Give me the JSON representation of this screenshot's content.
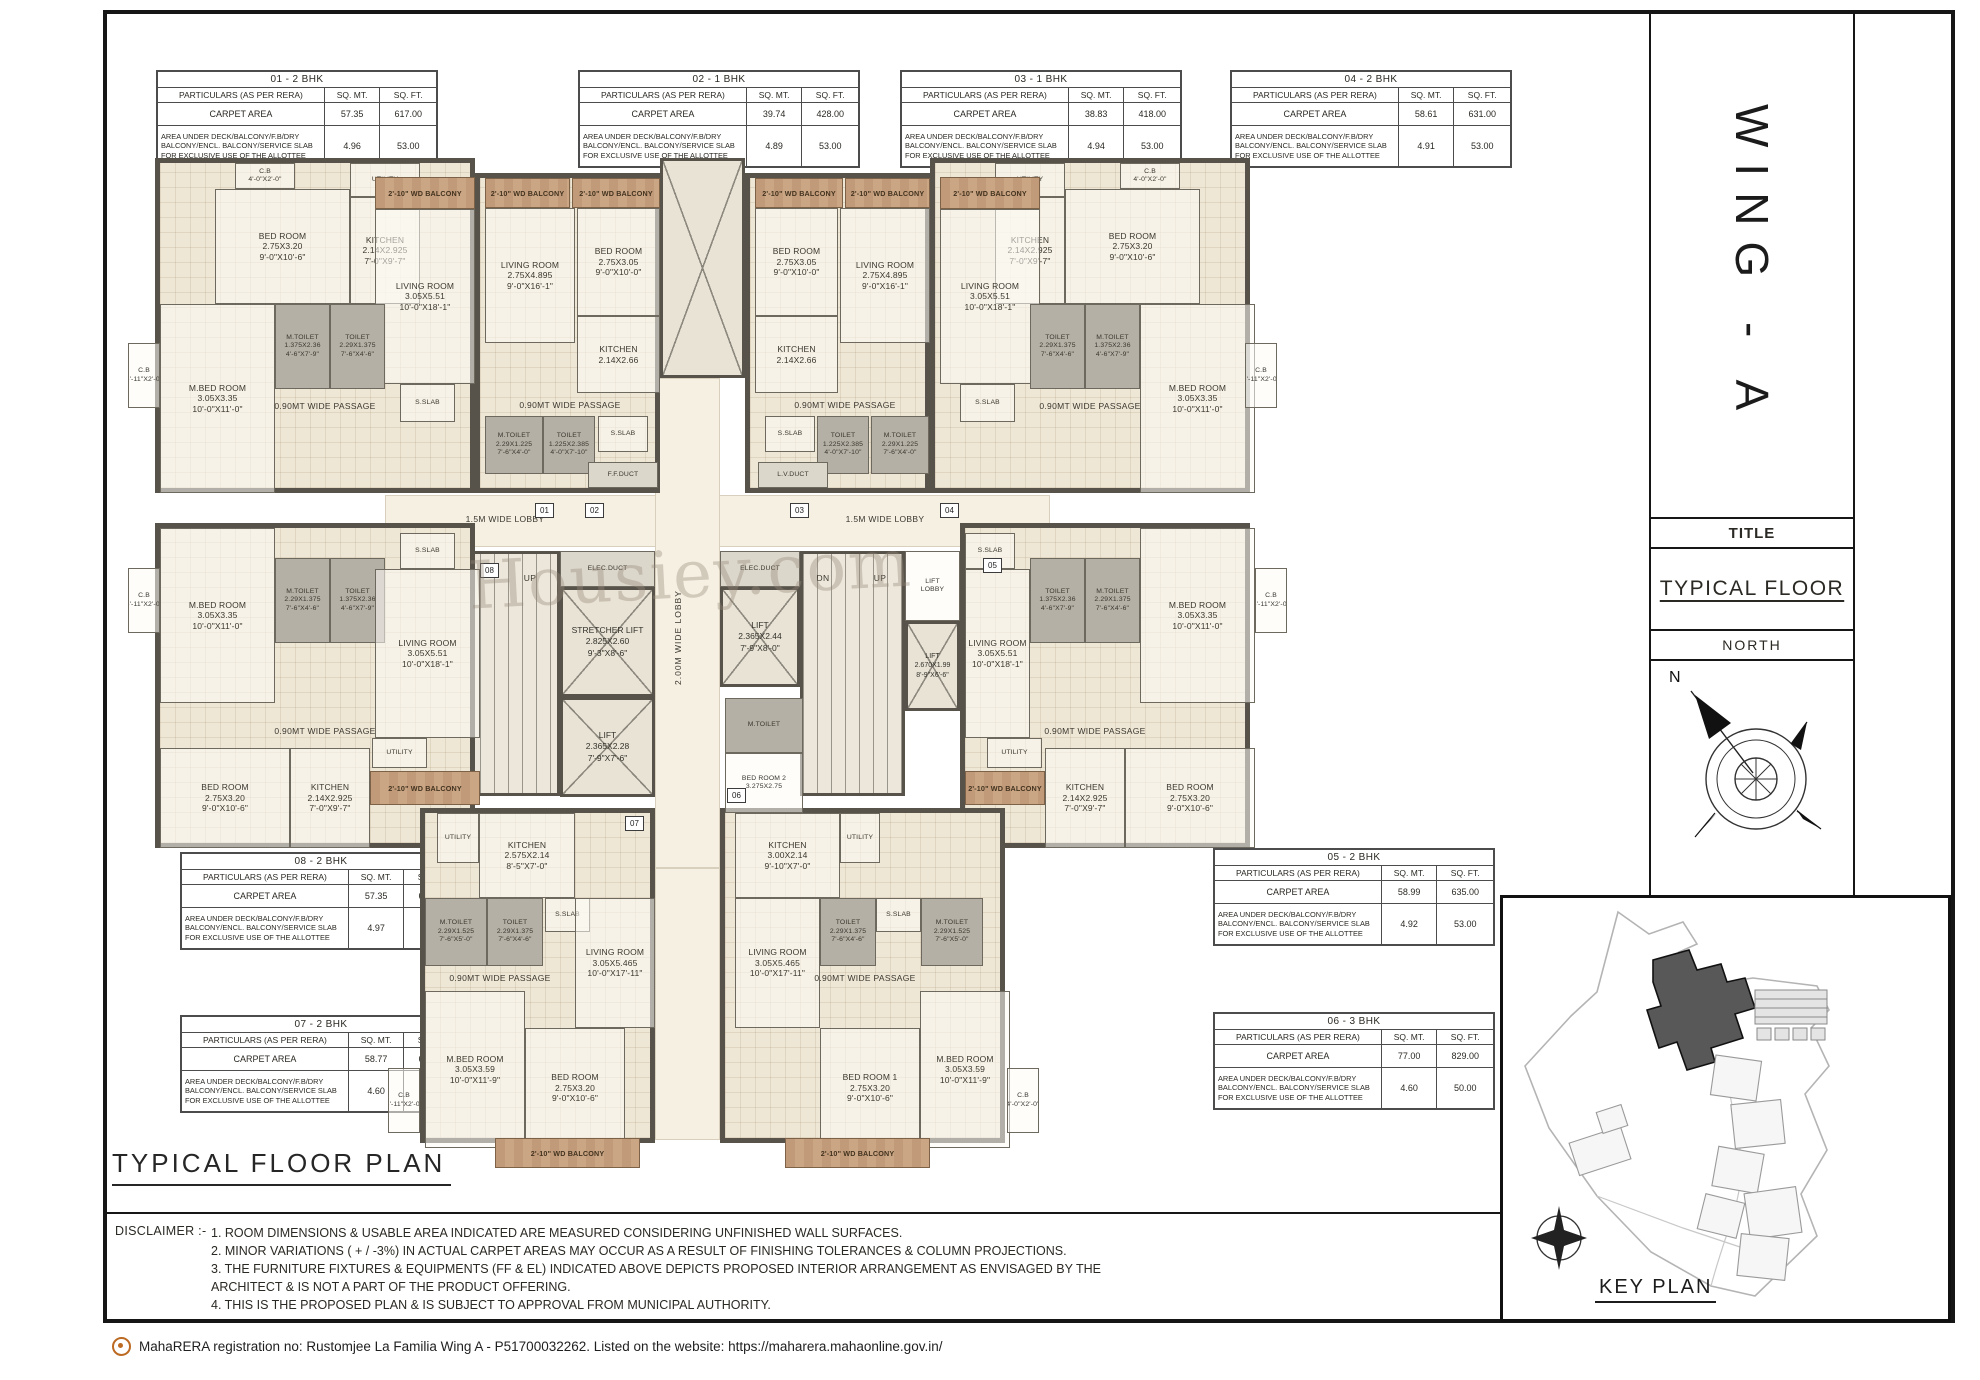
{
  "sheet": {
    "heading": "TYPICAL  FLOOR  PLAN",
    "watermark": "Housiey.com",
    "footer": "MahaRERA registration no: Rustomjee La Familia Wing A - P51700032262. Listed on the website: https://maharera.mahaonline.gov.in/"
  },
  "sidebar": {
    "wing": "WING - A",
    "title_label": "TITLE",
    "title_value": "TYPICAL FLOOR",
    "north_label": "NORTH",
    "north_n": "N",
    "keyplan_label": "KEY PLAN"
  },
  "disclaimer": {
    "label": "DISCLAIMER :-",
    "items": [
      "1. ROOM DIMENSIONS & USABLE  AREA INDICATED  ARE MEASURED CONSIDERING UNFINISHED WALL SURFACES.",
      "2. MINOR VARIATIONS ( + / -3%) IN ACTUAL CARPET AREAS MAY OCCUR AS A RESULT OF  FINISHING TOLERANCES & COLUMN PROJECTIONS.",
      "3. THE FURNITURE FIXTURES & EQUIPMENTS (FF & EL)  INDICATED ABOVE  DEPICTS PROPOSED INTERIOR ARRANGEMENT AS ENVISAGED BY  THE\n      ARCHITECT & IS NOT A PART OF THE PRODUCT OFFERING.",
      "4. THIS IS THE PROPOSED PLAN & IS SUBJECT TO APPROVAL FROM MUNICIPAL AUTHORITY."
    ]
  },
  "table_common": {
    "col_particulars": "PARTICULARS (AS PER RERA)",
    "col_sqmt": "SQ. MT.",
    "col_sqft": "SQ. FT.",
    "carpet_label": "CARPET AREA",
    "deck_label": "AREA UNDER DECK/BALCONY/F.B/DRY BALCONY/ENCL. BALCONY/SERVICE SLAB FOR EXCLUSIVE USE OF THE ALLOTTEE"
  },
  "tables": [
    {
      "id": "01",
      "title": "01 - 2 BHK",
      "carpet_sqmt": "57.35",
      "carpet_sqft": "617.00",
      "deck_sqmt": "4.96",
      "deck_sqft": "53.00"
    },
    {
      "id": "02",
      "title": "02 - 1 BHK",
      "carpet_sqmt": "39.74",
      "carpet_sqft": "428.00",
      "deck_sqmt": "4.89",
      "deck_sqft": "53.00"
    },
    {
      "id": "03",
      "title": "03 - 1 BHK",
      "carpet_sqmt": "38.83",
      "carpet_sqft": "418.00",
      "deck_sqmt": "4.94",
      "deck_sqft": "53.00"
    },
    {
      "id": "04",
      "title": "04 - 2 BHK",
      "carpet_sqmt": "58.61",
      "carpet_sqft": "631.00",
      "deck_sqmt": "4.91",
      "deck_sqft": "53.00"
    },
    {
      "id": "05",
      "title": "05 - 2 BHK",
      "carpet_sqmt": "58.99",
      "carpet_sqft": "635.00",
      "deck_sqmt": "4.92",
      "deck_sqft": "53.00"
    },
    {
      "id": "06",
      "title": "06 - 3 BHK",
      "carpet_sqmt": "77.00",
      "carpet_sqft": "829.00",
      "deck_sqmt": "4.60",
      "deck_sqft": "50.00"
    },
    {
      "id": "07",
      "title": "07 - 2 BHK",
      "carpet_sqmt": "58.77",
      "carpet_sqft": "633.00",
      "deck_sqmt": "4.60",
      "deck_sqft": "50.00"
    },
    {
      "id": "08",
      "title": "08 - 2 BHK",
      "carpet_sqmt": "57.35",
      "carpet_sqft": "617.00",
      "deck_sqmt": "4.97",
      "deck_sqft": "53.00"
    }
  ],
  "plan": {
    "tags": [
      "01",
      "02",
      "03",
      "04",
      "05",
      "06",
      "07",
      "08"
    ],
    "core": {
      "lobby": "1.5M WIDE LOBBY",
      "vlobby": "2.00M WIDE LOBBY",
      "elec": "ELEC.DUCT",
      "stretcher": "STRETCHER LIFT\n2.825X2.60\n9'-3\"X8'-6\"",
      "lift1": "LIFT\n2.365X2.28\n7'-9\"X7'-6\"",
      "lift2": "LIFT\n2.365X2.44\n7'-9\"X8'-0\"",
      "lift4": "LIFT\n2.670X1.99\n8'-9\"X6'-6\"",
      "liftlobby": "LIFT\nLOBBY",
      "dn": "DN",
      "up": "UP",
      "wpass": "1.20 MT WD PASSAGE"
    },
    "units": {
      "u01": {
        "cb1": "C.B\n4'-0\"X2'-0\"",
        "bed": "BED ROOM\n2.75X3.20\n9'-0\"X10'-6\"",
        "utility": "UTILITY",
        "kitchen": "KITCHEN\n2.14X2.925\n7'-0\"X9'-7\"",
        "balcony": "2'-10\" WD BALCONY",
        "living": "LIVING ROOM\n3.05X5.51\n10'-0\"X18'-1\"",
        "mbed": "M.BED ROOM\n3.05X3.35\n10'-0\"X11'-0\"",
        "mtoilet": "M.TOILET\n1.375X2.36\n4'-6\"X7'-9\"",
        "toilet": "TOILET\n2.29X1.375\n7'-6\"X4'-6\"",
        "sslab": "S.SLAB",
        "passage": "0.90MT WIDE PASSAGE",
        "cb2": "C.B\n5'-11\"X2'-0\""
      },
      "u02": {
        "balcony": "2'-10\" WD BALCONY",
        "living": "LIVING ROOM\n2.75X4.895\n9'-0\"X16'-1\"",
        "bed": "BED ROOM\n2.75X3.05\n9'-0\"X10'-0\"",
        "kitchen": "KITCHEN\n2.14X2.66",
        "mtoilet": "M.TOILET\n2.29X1.225\n7'-6\"X4'-0\"",
        "toilet": "TOILET\n1.225X2.385\n4'-0\"X7'-10\"",
        "sslab": "S.SLAB",
        "passage": "0.90MT WIDE PASSAGE",
        "ffduct": "F.F.DUCT"
      },
      "u03": {
        "balcony": "2'-10\" WD BALCONY",
        "living": "LIVING ROOM\n2.75X4.895\n9'-0\"X16'-1\"",
        "bed": "BED ROOM\n2.75X3.05\n9'-0\"X10'-0\"",
        "kitchen": "KITCHEN\n2.14X2.66",
        "mtoilet": "M.TOILET\n2.29X1.225\n7'-6\"X4'-0\"",
        "toilet": "TOILET\n1.225X2.385\n4'-0\"X7'-10\"",
        "sslab": "S.SLAB",
        "passage": "0.90MT WIDE PASSAGE",
        "lvduct": "L.V.DUCT"
      },
      "u04": {
        "cb1": "C.B\n4'-0\"X2'-0\"",
        "bed": "BED ROOM\n2.75X3.20\n9'-0\"X10'-6\"",
        "utility": "UTILITY",
        "kitchen": "KITCHEN\n2.14X2.925\n7'-0\"X9'-7\"",
        "balcony": "2'-10\" WD BALCONY",
        "living": "LIVING ROOM\n3.05X5.51\n10'-0\"X18'-1\"",
        "mbed": "M.BED ROOM\n3.05X3.35\n10'-0\"X11'-0\"",
        "mtoilet": "M.TOILET\n1.375X2.36\n4'-6\"X7'-9\"",
        "toilet": "TOILET\n2.29X1.375\n7'-6\"X4'-6\"",
        "sslab": "S.SLAB",
        "passage": "0.90MT WIDE PASSAGE",
        "cb2": "C.B\n3'-11\"X2'-0\""
      },
      "u08": {
        "cb": "C.B\n5'-11\"X2'-0\"",
        "sslab": "S.SLAB",
        "mbed": "M.BED ROOM\n3.05X3.35\n10'-0\"X11'-0\"",
        "mtoilet": "M.TOILET\n2.29X1.375\n7'-6\"X4'-6\"",
        "toilet": "TOILET\n1.375X2.36\n4'-6\"X7'-9\"",
        "living": "LIVING ROOM\n3.05X5.51\n10'-0\"X18'-1\"",
        "passage": "0.90MT WIDE PASSAGE",
        "bed": "BED ROOM\n2.75X3.20\n9'-0\"X10'-6\"",
        "kitchen": "KITCHEN\n2.14X2.925\n7'-0\"X9'-7\"",
        "utility": "UTILITY",
        "balcony": "2'-10\" WD BALCONY"
      },
      "u05": {
        "cb": "C.B\n5'-11\"X2'-0\"",
        "sslab": "S.SLAB",
        "mbed": "M.BED ROOM\n3.05X3.35\n10'-0\"X11'-0\"",
        "mtoilet": "M.TOILET\n2.29X1.375\n7'-6\"X4'-6\"",
        "toilet": "TOILET\n1.375X2.36\n4'-6\"X7'-9\"",
        "living": "LIVING ROOM\n3.05X5.51\n10'-0\"X18'-1\"",
        "passage": "0.90MT WIDE PASSAGE",
        "bed": "BED ROOM\n2.75X3.20\n9'-0\"X10'-6\"",
        "kitchen": "KITCHEN\n2.14X2.925\n7'-0\"X9'-7\"",
        "utility": "UTILITY",
        "balcony": "2'-10\" WD BALCONY"
      },
      "u07": {
        "utility": "UTILITY",
        "kitchen": "KITCHEN\n2.575X2.14\n8'-5\"X7'-0\"",
        "mtoilet": "M.TOILET\n2.29X1.525\n7'-6\"X5'-0\"",
        "toilet": "TOILET\n2.29X1.375\n7'-6\"X4'-6\"",
        "sslab": "S.SLAB",
        "living": "LIVING ROOM\n3.05X5.465\n10'-0\"X17'-11\"",
        "passage": "0.90MT WIDE PASSAGE",
        "mbed": "M.BED ROOM\n3.05X3.59\n10'-0\"X11'-9\"",
        "bed": "BED ROOM\n2.75X3.20\n9'-0\"X10'-6\"",
        "balcony": "2'-10\" WD BALCONY",
        "cb": "C.B\n3'-11\"X2'-0\""
      },
      "u06": {
        "kitchen": "KITCHEN\n3.00X2.14\n9'-10\"X7'-0\"",
        "utility": "UTILITY",
        "living": "LIVING ROOM\n3.05X5.465\n10'-0\"X17'-11\"",
        "toilet": "TOILET\n2.29X1.375\n7'-6\"X4'-6\"",
        "sslab": "S.SLAB",
        "mtoilet": "M.TOILET\n2.29X1.525\n7'-6\"X5'-0\"",
        "passage": "0.90MT WIDE PASSAGE",
        "bed1": "BED ROOM 1\n2.75X3.20\n9'-0\"X10'-6\"",
        "mbed": "M.BED ROOM\n3.05X3.59\n10'-0\"X11'-9\"",
        "bed2": "BED ROOM 2\n3.275X2.75",
        "mtoilet2": "M.TOILET",
        "balcony": "2'-10\" WD BALCONY",
        "cb": "C.B\n4'-0\"X2'-0\""
      }
    }
  }
}
